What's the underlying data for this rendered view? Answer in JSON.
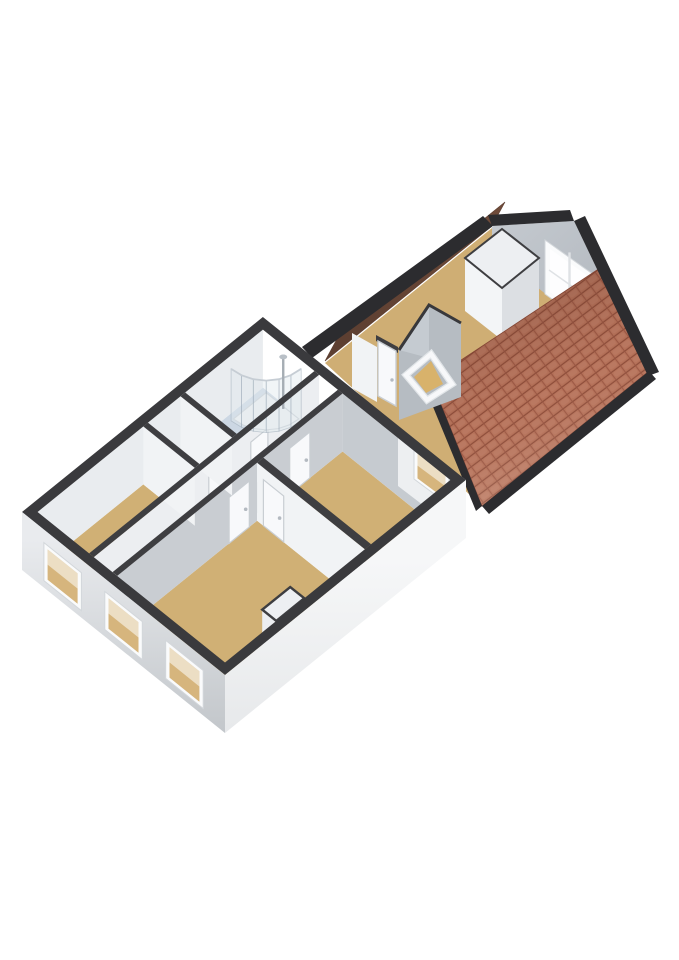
{
  "scene": {
    "title": "3D floor plan render",
    "description": "Axonometric 3D floor plan of an upper storey: main section with bedrooms, hallway, toilet and bathroom with corner shower, connected to an attic extension with tiled gable roof, gable window and stair opening with railing",
    "view": "axonometric-top-down",
    "background": "#ffffff",
    "width": 679,
    "height": 960
  },
  "palette": {
    "background": "#ffffff",
    "wall_top": "#3e3e41",
    "outer_ring": "#3a3a3d",
    "roof_edge": "#2c2c2f",
    "wood": "#d0b075",
    "wood_attic": "#cfae74",
    "bath": "#ccd7e3",
    "hall": "#c9cdd2",
    "stairs": "#d8b26b",
    "int_bright": "#f1f3f5",
    "int_medium": "#eceef1",
    "int_gray": "#c9cdd2",
    "int_gray2": "#c6cbd0",
    "nw_inner": "#e9ecef",
    "ext_sw_top": "#e9ebee",
    "ext_sw_bottom": "#c2c6ca",
    "ext_se_top": "#f6f7f8",
    "ext_se_bottom": "#e6e8ea",
    "ne_sliver": "#edeff1",
    "door": "#f8f9fb",
    "door_frame": "#c9ced3",
    "handle": "#b4bac1",
    "window_frame": "#fafbfc",
    "window_glass_floor": "#d6b57d",
    "window_glass": "#fdfdfe",
    "mullion": "#dfe2e5",
    "tile": "#b9755c",
    "tile_line": "#8f4e3b",
    "tile_line2": "#9a5743",
    "tile_highlight": "#c98a72",
    "tile_edge": "#8a4a38",
    "slope_shadow": "#6f4b3a",
    "slope_shadow_dark": "#5d3f31",
    "gable_light": "#c3c8ce",
    "gable_dark": "#aab0b7",
    "vest_gray": "#b6bcc2",
    "vest_facet": "#c5cbd1",
    "closet_top": "#edeff2",
    "closet_front": "#f3f5f7",
    "closet_side": "#dcdfe3",
    "rail": "#f7f8fa",
    "rail_under": "#e2e6e9",
    "shower_tray": "#eef0f3",
    "shower_tray_edge": "#c8ced4",
    "shower_glass": "rgba(223,232,238,0.45)",
    "shower_glass_edge": "rgba(155,170,182,0.55)",
    "chrome": "#a6adb4"
  },
  "buildings": [
    {
      "id": "main-section",
      "rooms": [
        {
          "name": "living-room",
          "floor": "wood"
        },
        {
          "name": "bedroom",
          "floor": "wood"
        },
        {
          "name": "study",
          "floor": "wood"
        },
        {
          "name": "toilet",
          "floor": "bath"
        },
        {
          "name": "bathroom",
          "floor": "bath"
        },
        {
          "name": "hallway",
          "floor": "hall"
        }
      ],
      "features": {
        "corner_shower": true,
        "chimney_niche": true,
        "southwest_windows": 3,
        "northeast_windows": 1,
        "interior_doors": 5
      }
    },
    {
      "id": "attic-extension",
      "rooms": [
        {
          "name": "attic-room",
          "floor": "wood_attic"
        }
      ],
      "features": {
        "tiled_roof_slope": true,
        "shadowed_roof_slope": true,
        "gable_window": true,
        "closet": true,
        "stair_opening_with_railing": true,
        "landing_door": true
      }
    }
  ]
}
